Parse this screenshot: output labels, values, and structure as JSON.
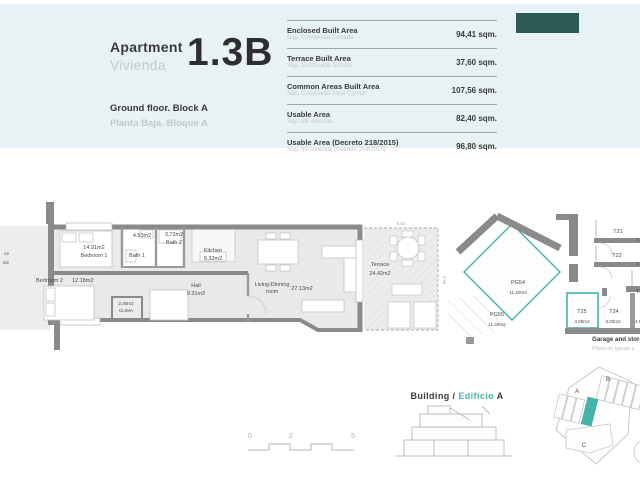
{
  "header": {
    "apartment_label_en": "Apartment",
    "apartment_label_es": "Vivienda",
    "unit_number": "1.3B",
    "floor_en": "Ground floor.  Block A",
    "floor_es": "Planta Baja.  Bloque A"
  },
  "areas_table": {
    "rows": [
      {
        "title": "Enclosed Built Area",
        "subtitle": "Sup. Construida Cerrada",
        "value": "94,41 sqm."
      },
      {
        "title": "Terrace Built Area",
        "subtitle": "Sup. Construida Terraza",
        "value": "37,60 sqm."
      },
      {
        "title": "Common Areas Built Area",
        "subtitle": "Sup. Construida Zona Común",
        "value": "107,56 sqm."
      },
      {
        "title": "Usable Area",
        "subtitle": "Sup. útil vivienda",
        "value": "82,40 sqm."
      },
      {
        "title": "Usable Area (Decreto 218/2015)",
        "subtitle": "Sup. útil vivienda (Decreto 218/2015)",
        "value": "96,80 sqm."
      }
    ]
  },
  "floor_plan": {
    "neighbor_line1": "ce",
    "neighbor_line2": "m2",
    "rooms": {
      "bedroom1": {
        "area": "14.91m2",
        "name": "Bedroom 1"
      },
      "bedroom2": {
        "name": "Bedroom 2",
        "area": "12.18m2"
      },
      "bath1": {
        "area": "4.53m2",
        "name": "Bath 1"
      },
      "bath2": {
        "area": "3.72m2",
        "name": "Bath 2"
      },
      "kitchen": {
        "name": "Kitchen",
        "area": "8.32m2"
      },
      "hall": {
        "name": "Hall",
        "area": "9.31m2"
      },
      "living": {
        "name": "Living-Dinning",
        "name2": "room",
        "area": "27.13m2"
      },
      "clima": {
        "area": "2.30m2",
        "name": "CLIMA"
      },
      "terrace": {
        "name": "Terrace",
        "area": "24.42m2"
      }
    },
    "dimensions": {
      "terrace_width": "6.62",
      "terrace_depth": "5.58"
    }
  },
  "garage": {
    "pg54_name": "PG54",
    "pg54_area": "11.40m2",
    "pg55_name": "PG55",
    "pg55_area": "11.40m2",
    "t21": "T21",
    "t21_area": "3.9",
    "t22": "T22",
    "t22_area": "3.9",
    "t23_partial": "T2",
    "t24": "T24",
    "t24_area": "3.00m2",
    "t25": "T25",
    "t25_area": "3.00m2",
    "t26_area_partial": "4.6",
    "caption_en": "Garage and storage",
    "caption_es": "Plaza de garaje y"
  },
  "scale_bar": {
    "labels": [
      "0",
      "2",
      "5"
    ]
  },
  "building_key": {
    "label_en": "Building",
    "separator": "/",
    "label_es": "Edificio",
    "block": "A"
  },
  "site_plan": {
    "blocks": [
      "A",
      "B",
      "C"
    ]
  },
  "colors": {
    "accent_teal": "#45b3a8",
    "panel_blue": "#e8f1f3",
    "logo_dark": "#2b5a57",
    "wall_gray": "#8a8a8a"
  }
}
